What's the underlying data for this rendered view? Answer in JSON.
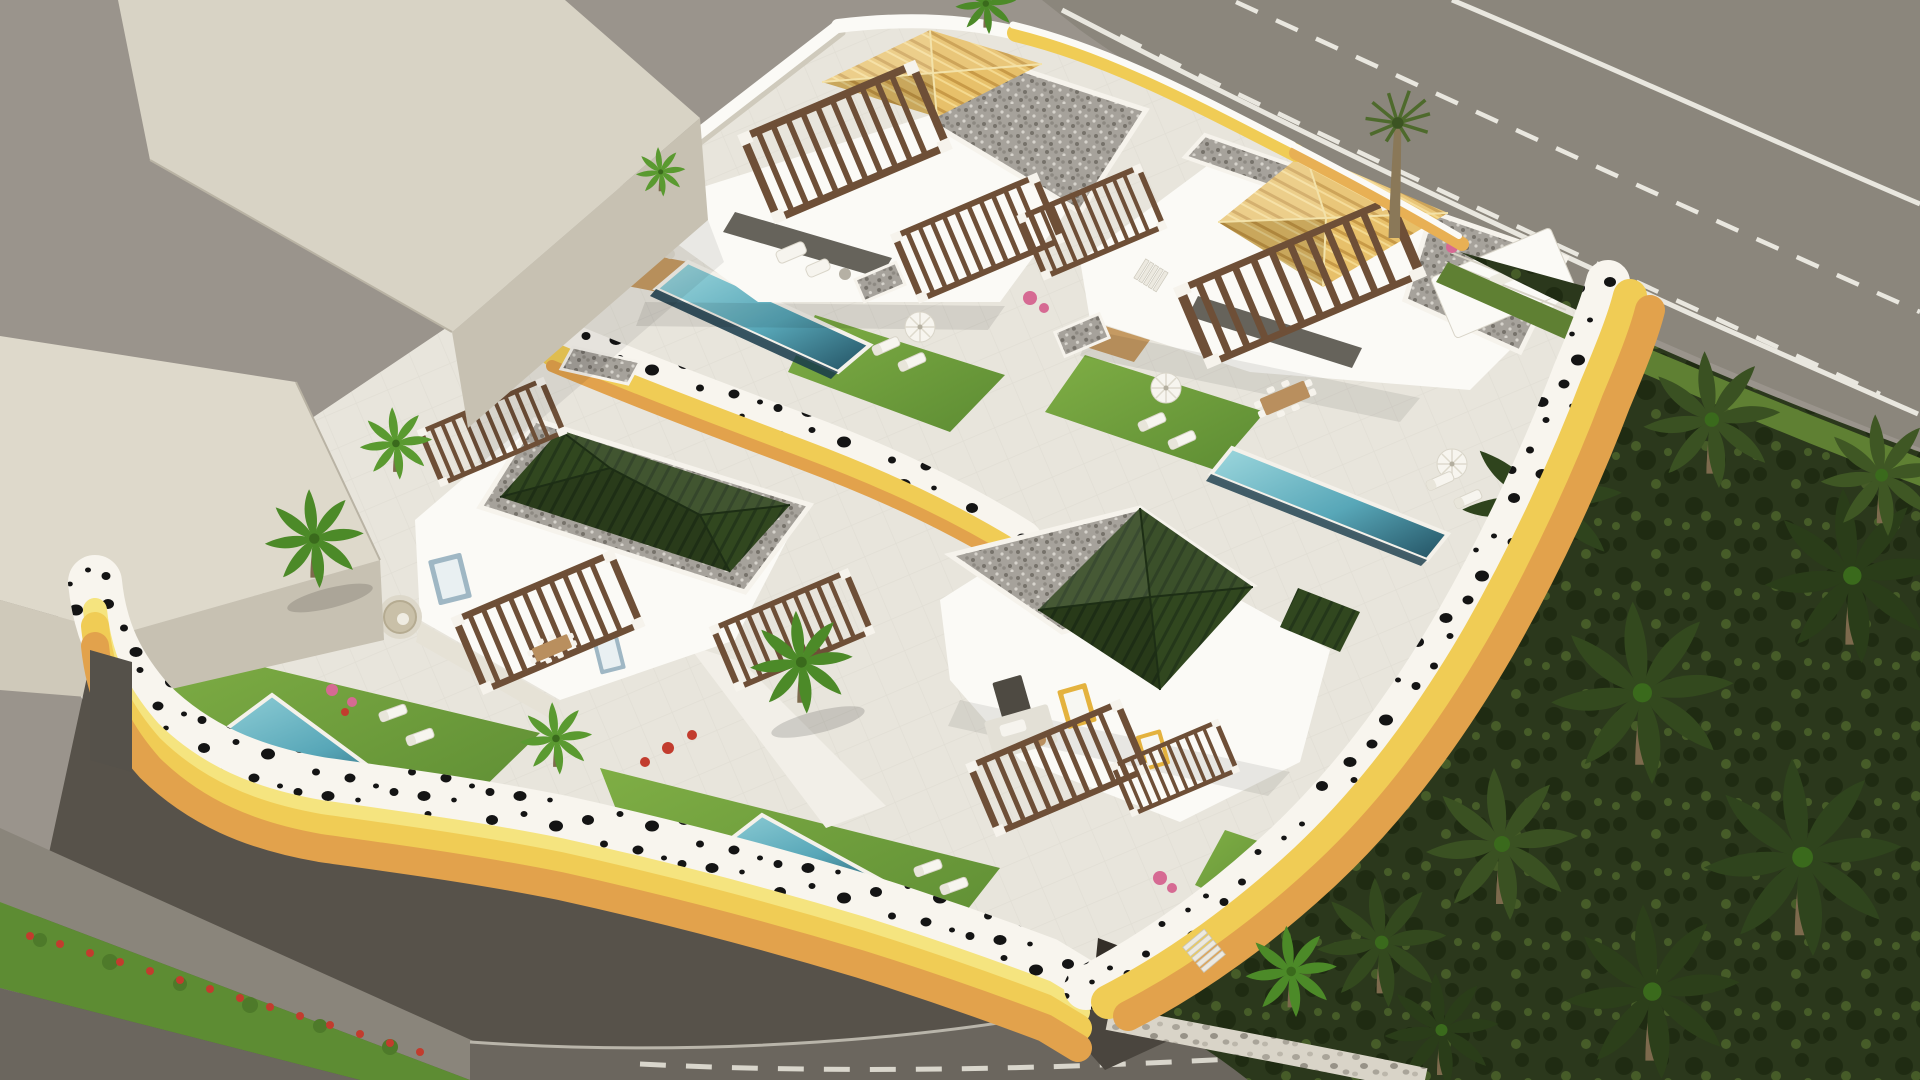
{
  "meta": {
    "title": "Aerial 3D architectural render — four-villa hillside development",
    "view": "aerial axonometric",
    "style": "architectural visualization, no text overlays"
  },
  "palette": {
    "background": "#9a948c",
    "massing_top": "#d8d3c5",
    "massing_face": "#c7c1b2",
    "massing_light": "#ded9cb",
    "road_top": "#8b867c",
    "road_marking": "#e9e7df",
    "road_dark": "#57524a",
    "road_mid": "#6b665e",
    "sidewalk": "#8a857b",
    "paving": "#e8e5dc",
    "terrace": "#dfdcd2",
    "wall_white": "#f8f5ee",
    "wall_pale": "#f5e47f",
    "wall_yellow": "#f0cc55",
    "wall_ochre": "#e2a24c",
    "pool_light": "#9ed8de",
    "pool_mid": "#58a7b8",
    "pool_deep": "#214f60",
    "lawn": "#74a03c",
    "lawn_dark": "#5d8c33",
    "roof_yellow": "#e7c06a",
    "roof_yellow_stripe": "#c89a47",
    "roof_green": "#31471f",
    "roof_green_dark": "#24371a",
    "gravel": "#a6a29b",
    "vegetation": "#2b381c",
    "vegetation_crown": "#3c5124",
    "palm_green": "#4c8a28",
    "palm_trunk": "#7d6a4d",
    "pergola_wood": "#6e4f37",
    "deck_wood": "#c59a62",
    "flower_red": "#c23c2e",
    "flower_pink": "#d66a93",
    "white": "#fbfaf6"
  },
  "scene": {
    "neighborhood": {
      "label": "adjacent untextured building massing (upper left)"
    },
    "roads": {
      "upper": {
        "label": "main road",
        "lanes": 2,
        "markings": "white dashed lane lines and solid edge lines"
      },
      "lower": {
        "label": "access street",
        "features": [
          "sidewalk",
          "red flower hedge",
          "dashed center line",
          "stone pebble wall"
        ]
      }
    },
    "estate": {
      "label": "walled villa compound on terraced hillside",
      "walls": "white retaining walls with wavy yellow-ochre bands and black dot pattern",
      "pools": 4,
      "villas": [
        {
          "id": "villa-1",
          "position": "top-center",
          "roof": "yellow barrel-tile hip + gravel flat roof",
          "amenities": [
            "wood pergolas",
            "rectangular pool",
            "timber deck",
            "hanging egg chair",
            "lawn",
            "sun loungers",
            "parasol"
          ]
        },
        {
          "id": "villa-2",
          "position": "upper-right",
          "roof": "yellow barrel-tile hip + gravel flat roof",
          "amenities": [
            "wood pergola",
            "outdoor dining",
            "lawn",
            "sun loungers",
            "parasol",
            "plunge pool",
            "balcony"
          ]
        },
        {
          "id": "villa-3",
          "position": "center-left",
          "roof": "dark green ribbed hip with gravel border",
          "amenities": [
            "wood pergolas",
            "sunken lounge",
            "palm garden",
            "triangular infinity pool",
            "sun loungers"
          ]
        },
        {
          "id": "villa-4",
          "position": "center-bottom",
          "roof": "dark green ribbed hip + gravel flat roof",
          "amenities": [
            "wood pergolas",
            "roof terrace",
            "yellow framed windows",
            "triangular infinity pool",
            "garage driveway",
            "exterior stairs"
          ]
        }
      ]
    },
    "vegetation": {
      "right_slope": "dense dark palm grove hillside",
      "accents": [
        "tall fan palms along road",
        "bright palms in gardens",
        "bougainvillea",
        "red flower hedge"
      ]
    }
  }
}
